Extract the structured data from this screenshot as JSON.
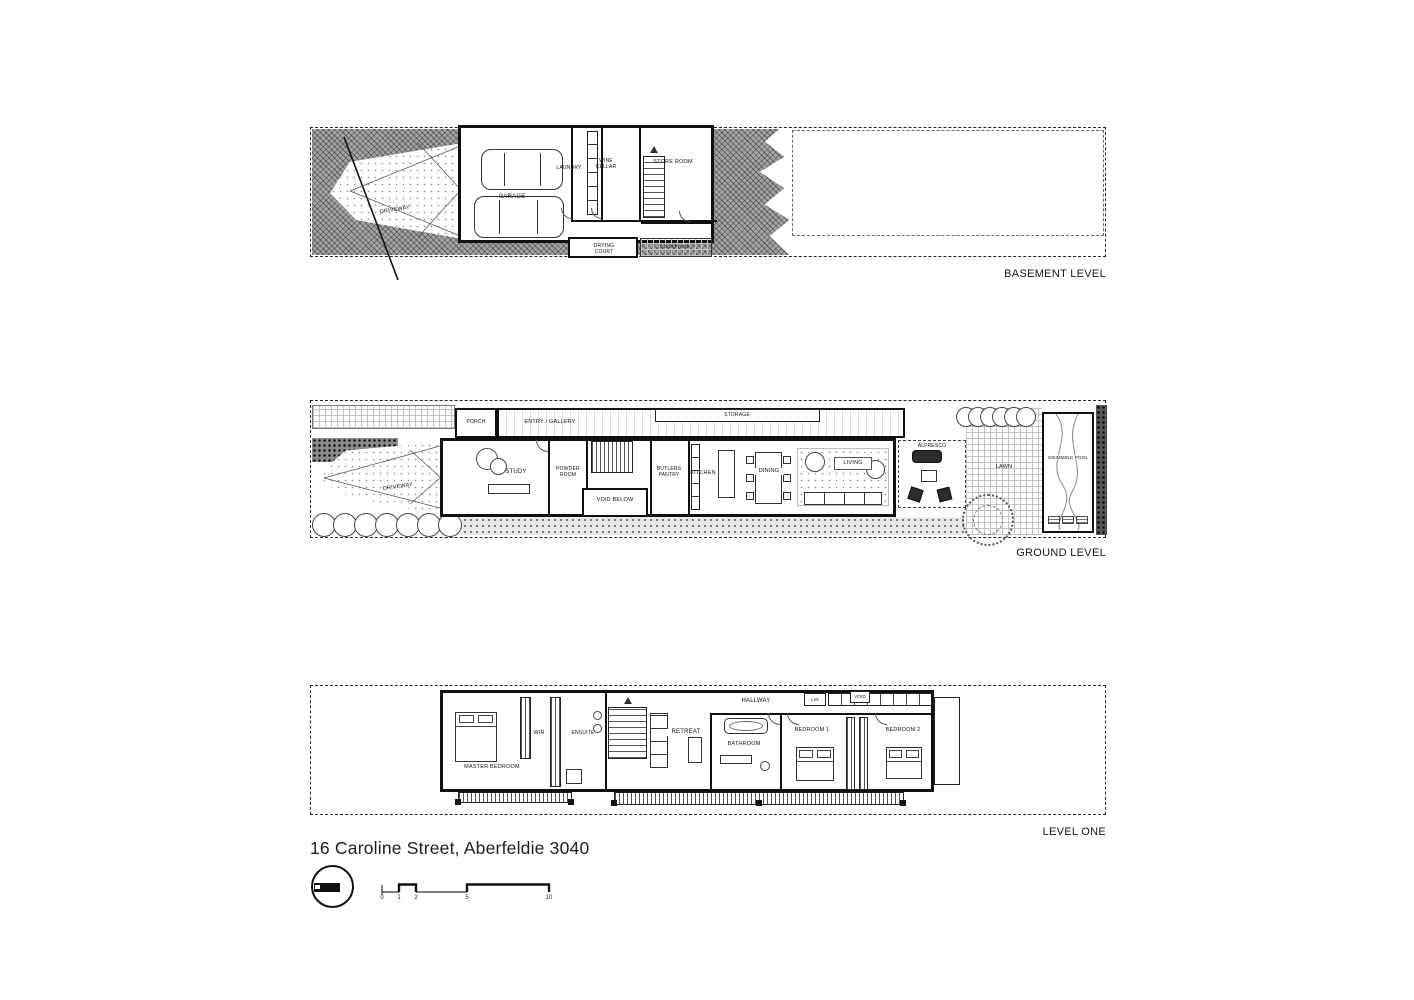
{
  "basement": {
    "title": "BASEMENT LEVEL",
    "rooms": {
      "driveway": "DRIVEWAY",
      "garage": "GARAGE",
      "laundry": "LAUNDRY",
      "wine_cellar": "WINE CELLAR",
      "store_room": "STORE ROOM",
      "drying_court": "DRYING COURT",
      "courtyard": "COURTYARD"
    }
  },
  "ground": {
    "title": "GROUND LEVEL",
    "rooms": {
      "porch": "PORCH",
      "entry_gallery": "ENTRY / GALLERY",
      "storage": "STORAGE",
      "driveway": "DRIVEWAY",
      "study": "STUDY",
      "powder_room": "POWDER ROOM",
      "void_below": "VOID BELOW",
      "butlers_pantry": "BUTLERS PANTRY",
      "kitchen": "KITCHEN",
      "dining": "DINING",
      "living": "LIVING",
      "alfresco": "ALFRESCO",
      "lawn": "LAWN",
      "swimming_pool": "SWIMMING POOL"
    }
  },
  "level_one": {
    "title": "LEVEL ONE",
    "rooms": {
      "master_bedroom": "MASTER BEDROOM",
      "wir": "WIR",
      "ensuite": "ENSUITE",
      "retreat": "RETREAT",
      "hallway": "HALLWAY",
      "bathroom": "BATHROOM",
      "bedroom_1": "BEDROOM 1",
      "bedroom_2": "BEDROOM 2",
      "lin": "LIN",
      "void": "VOID"
    }
  },
  "footer": {
    "address": "16 Caroline Street, Aberfeldie 3040",
    "scale_ticks": [
      "0",
      "1",
      "2",
      "5",
      "10"
    ]
  },
  "colors": {
    "ink": "#161616",
    "site_gray": "#a6a6a6"
  }
}
